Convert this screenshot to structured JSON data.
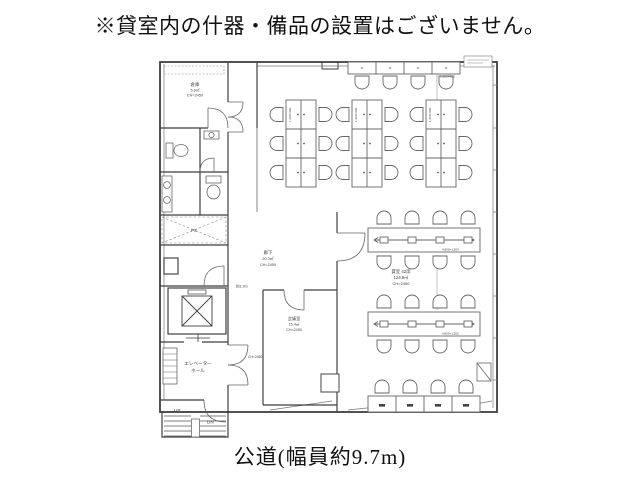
{
  "page": {
    "top_caption": "※貸室内の什器・備品の設置はございません。",
    "bottom_caption": "公道(幅員約9.7m)"
  },
  "rooms": {
    "storage": {
      "name": "倉庫",
      "area": "5.6㎡",
      "ceiling": "CH=2450"
    },
    "corridor": {
      "name": "廊下",
      "area": "20.3㎡",
      "ceiling": "CH=2450"
    },
    "meeting": {
      "name": "会議室",
      "area": "15.4㎡",
      "ceiling": "CH=2450"
    },
    "office": {
      "name": "貸室 42席",
      "area": "124.9㎡",
      "ceiling": "CH=2450"
    },
    "elevator_hall": {
      "name_line1": "エレベーター",
      "name_line2": "ホール"
    },
    "pipe_space": {
      "name": "PS"
    }
  },
  "stairs": {
    "up_label": "UP",
    "down_label": "DN"
  },
  "annotations": {
    "corridor_width": "約1.9m",
    "hall_ceiling": "CH=2450",
    "desk_size": "1,200×600",
    "table_size": "4,800×1,200"
  },
  "colors": {
    "wall": "#3f3f3f",
    "furniture": "#666666",
    "text": "#1a1a1a"
  }
}
